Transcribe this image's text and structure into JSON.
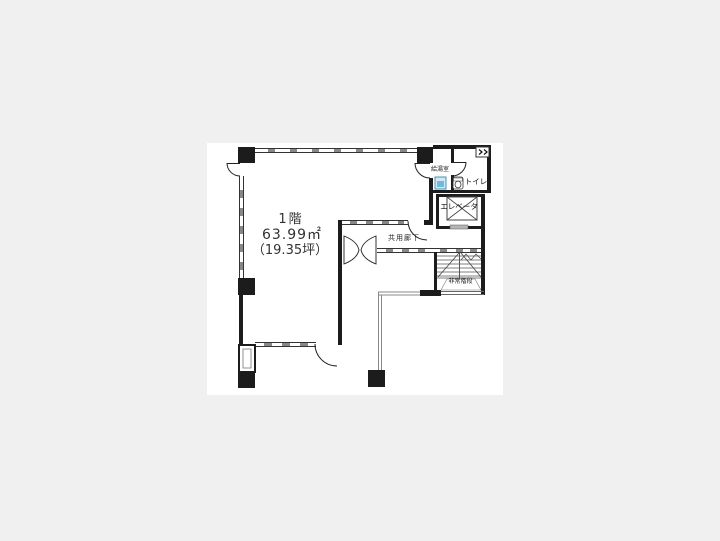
{
  "page": {
    "background_color": "#f0f0f0",
    "paper_color": "#ffffff"
  },
  "floor_plan": {
    "floor_label": "1階",
    "area_m2": "63.99㎡",
    "area_tsubo": "（19.35坪）",
    "rooms": {
      "kitchenette": "給湯室",
      "toilet": "トイレ",
      "elevator": "エレベータ",
      "corridor": "共用廊下",
      "emergency_stairs": "非常階段"
    },
    "icons": [
      "sink-icon",
      "toilet-icon",
      "ventilation-window-icon",
      "elevator-cabin-icon",
      "stairs-icon",
      "door-arc-icon",
      "entrance-double-swing-door-icon",
      "structural-column"
    ],
    "colors": {
      "wall": "#1c1c1c",
      "thin_line": "#888888",
      "tick": "#888888",
      "sink_fill": "#cfe9f5",
      "sink_accent": "#6fb9dc",
      "text": "#333333"
    }
  }
}
